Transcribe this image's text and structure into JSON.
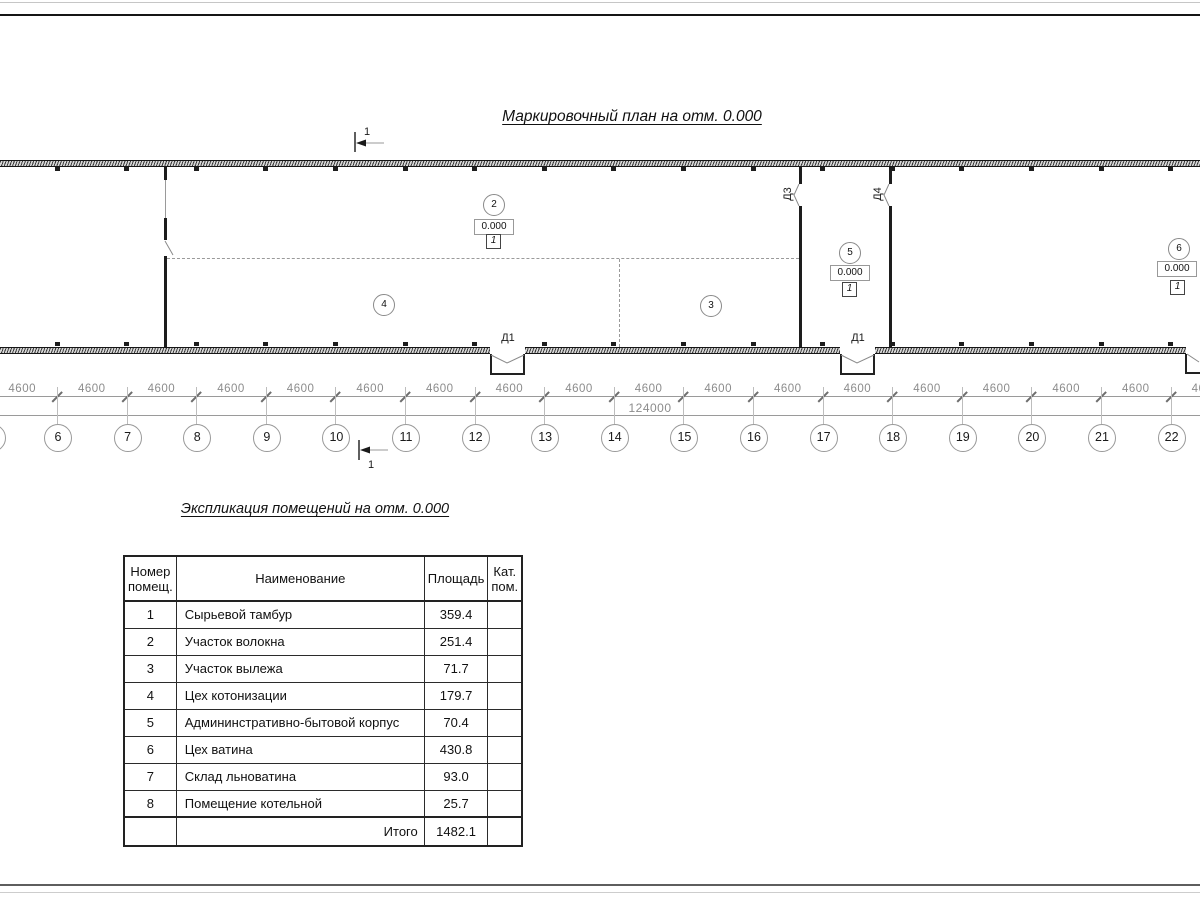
{
  "sheet": {
    "plan_title": "Маркировочный план на отм. 0.000",
    "section_mark": "1"
  },
  "plan": {
    "rooms": [
      {
        "number": "2",
        "elevation": "0.000",
        "category": "1"
      },
      {
        "number": "4"
      },
      {
        "number": "3"
      },
      {
        "number": "5",
        "elevation": "0.000",
        "category": "1"
      },
      {
        "number": "6",
        "elevation": "0.000",
        "category": "1"
      }
    ],
    "doors": [
      {
        "label": "Д1"
      },
      {
        "label": "Д1"
      },
      {
        "label": "Д3"
      },
      {
        "label": "Д4"
      }
    ]
  },
  "dimensions": {
    "bay_label": "4600",
    "bay_count": 18,
    "total_label": "124000"
  },
  "grid": {
    "bubbles": [
      "6",
      "7",
      "8",
      "9",
      "10",
      "11",
      "12",
      "13",
      "14",
      "15",
      "16",
      "17",
      "18",
      "19",
      "20",
      "21",
      "22"
    ]
  },
  "table": {
    "title": "Экспликация помещений на отм. 0.000",
    "headers": [
      "Номер\nпомещ.",
      "Наименование",
      "Площадь",
      "Кат.\nпом."
    ],
    "rows": [
      {
        "num": "1",
        "name": "Сырьевой тамбур",
        "area": "359.4",
        "cat": ""
      },
      {
        "num": "2",
        "name": "Участок волокна",
        "area": "251.4",
        "cat": ""
      },
      {
        "num": "3",
        "name": "Участок вылежа",
        "area": "71.7",
        "cat": ""
      },
      {
        "num": "4",
        "name": "Цех котонизации",
        "area": "179.7",
        "cat": ""
      },
      {
        "num": "5",
        "name": "Админинстративно-бытовой корпус",
        "area": "70.4",
        "cat": ""
      },
      {
        "num": "6",
        "name": "Цех ватина",
        "area": "430.8",
        "cat": ""
      },
      {
        "num": "7",
        "name": "Склад льноватина",
        "area": "93.0",
        "cat": ""
      },
      {
        "num": "8",
        "name": "Помещение котельной",
        "area": "25.7",
        "cat": ""
      }
    ],
    "total_label": "Итого",
    "total_value": "1482.1"
  },
  "colors": {
    "line_dark": "#1d1d1d",
    "line_gray": "#9a9a9a",
    "dim_text": "#8c8c8c"
  }
}
